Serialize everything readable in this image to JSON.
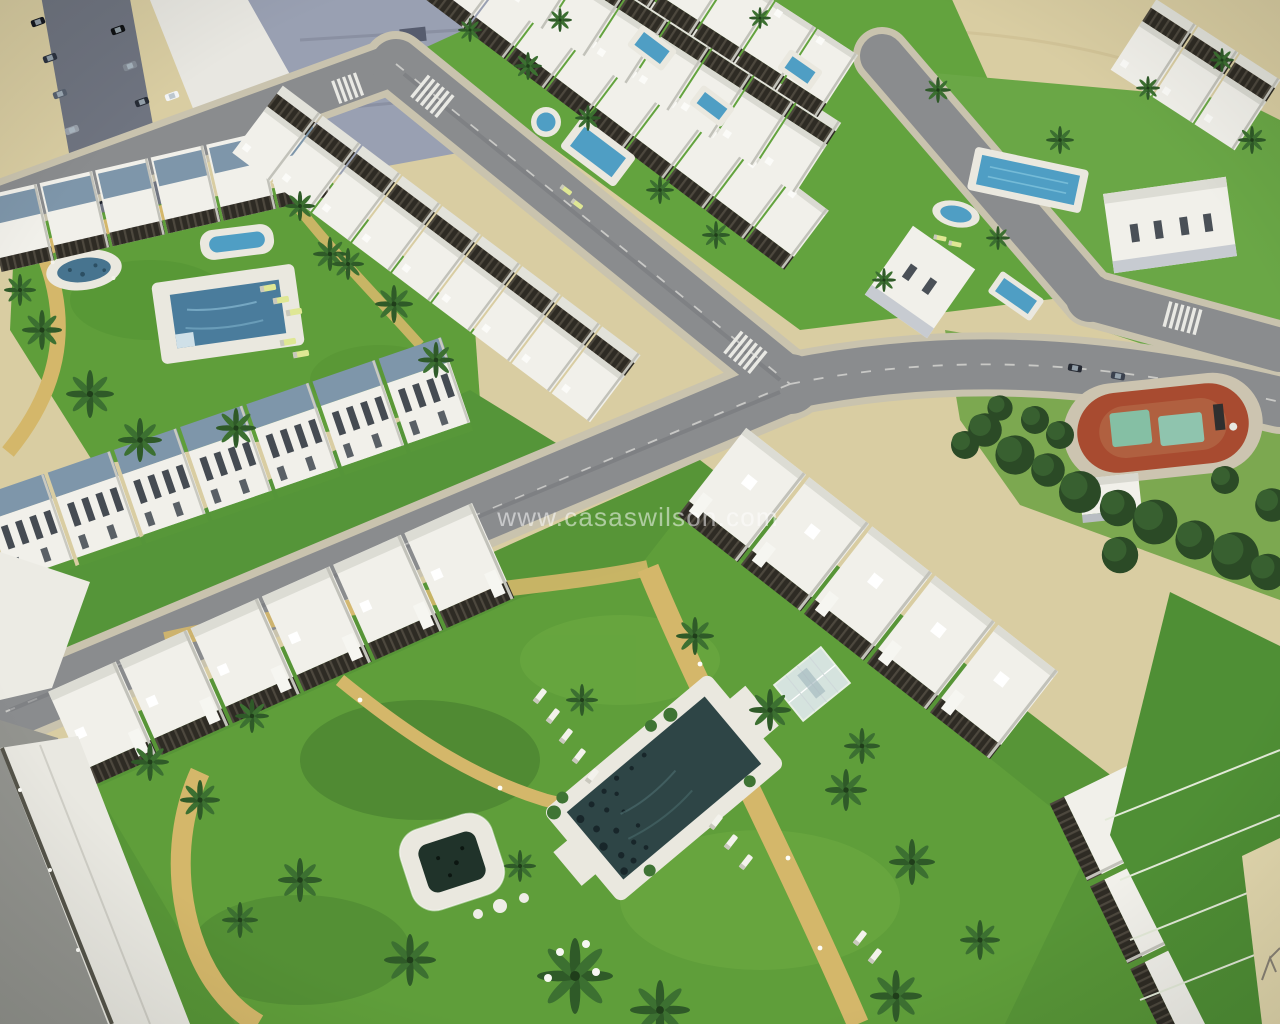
{
  "meta": {
    "type": "aerial-3d-architectural-render",
    "alt": "Aerial 3D render of a new-build coastal residential development: rows of white terraced townhouses with dark rooftop pergolas, communal lawns with swimming pools, palm trees, sandy paths, asphalt roads with zebra crossings, detached villas and a tree-lined park with a red playground track."
  },
  "watermark": {
    "text": "www.casaswilson.com"
  },
  "palette": {
    "sand": "#d9cda2",
    "sand_light": "#e3d8ae",
    "road": "#8a8c8e",
    "sidewalk": "#c9c3ae",
    "grass": "#5f9e3a",
    "grass_bright": "#6fb046",
    "grass_dark": "#3e7c2c",
    "park_grass": "#7ca850",
    "tree_dark": "#2b4a26",
    "tree_mid": "#386030",
    "building_white": "#f1f0ea",
    "building_shade": "#e2e2da",
    "roof_panel": "#7e96aa",
    "pergola": "#2e2b24",
    "path_tan": "#d4b76a",
    "pool_deck": "#eae8df",
    "pool_blue": "#4f9ec4",
    "pool_steel": "#4a7c9c",
    "pool_dark": "#2e4546",
    "jacuzzi_dark": "#20332a",
    "track_red": "#a84b30",
    "track_inner": "#b06040",
    "court_teal": "#85bfa4",
    "city_roof": "#99a0b2",
    "watermark": "#ffffff"
  },
  "features": [
    "existing town street with parked cars (top left)",
    "beach sand strip (top)",
    "terraced townhouse rows with rooftop pergolas and solar roof panels",
    "communal lawn with lagoon pool, spa pool and lap pool (upper left)",
    "small private garden pools between townhouse rows",
    "road junctions with zebra crossings",
    "detached white villas (upper right)",
    "tree-lined park with red playground track and teal courts (right)",
    "central garden with large dark pool, raised square jacuzzi, glass gazebo, white sun loungers, tan footpaths and palm trees (bottom)"
  ]
}
